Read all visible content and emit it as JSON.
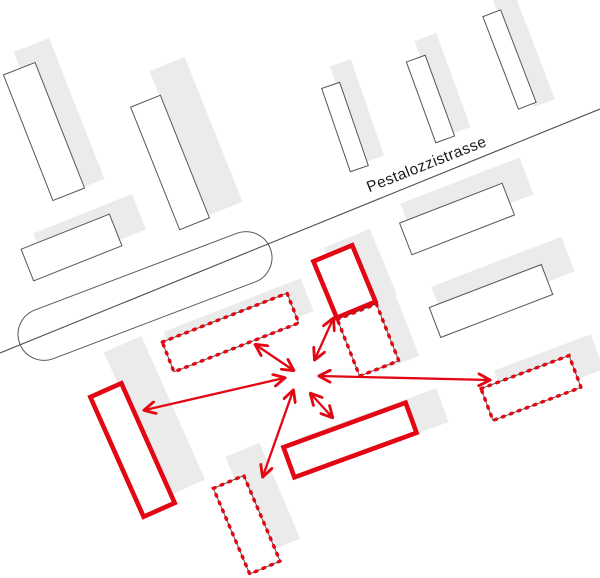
{
  "canvas": {
    "width": 600,
    "height": 578,
    "background": "#ffffff"
  },
  "palette": {
    "highlight_red": "#e30613",
    "shadow_gray": "#ebebeb",
    "building_outline": "#55565a",
    "dotted_underlay": "#4a4a4a",
    "street_line": "#4d4d4d",
    "label_color": "#1b1b1b",
    "building_fill": "#ffffff"
  },
  "street": {
    "label": "Pestalozzistrasse",
    "line": {
      "x1": 0,
      "y1": 353,
      "x2": 600,
      "y2": 109
    }
  },
  "plan": {
    "existing_buildings": [
      {
        "name": "existing-building-nw-1",
        "cx": 44,
        "cy": 131.5,
        "w": 34,
        "h": 135,
        "rot": -21.5,
        "shadow": {
          "dx": 15,
          "dy": -16,
          "s": 1.12
        }
      },
      {
        "name": "existing-building-nw-2",
        "cx": 170,
        "cy": 162.5,
        "w": 32,
        "h": 132,
        "rot": -21.8,
        "shadow": {
          "dx": 26,
          "dy": -26,
          "s": 1.18
        }
      },
      {
        "name": "existing-building-n-3",
        "cx": 345,
        "cy": 127,
        "w": 19,
        "h": 88,
        "rot": -19,
        "shadow": {
          "dx": 12,
          "dy": -16,
          "s": 1.16
        }
      },
      {
        "name": "existing-building-n-4",
        "cx": 430.5,
        "cy": 99,
        "w": 20,
        "h": 86,
        "rot": -20,
        "shadow": {
          "dx": 12,
          "dy": -15,
          "s": 1.16
        }
      },
      {
        "name": "existing-building-n-5",
        "cx": 509.5,
        "cy": 59.5,
        "w": 19,
        "h": 99,
        "rot": -21,
        "shadow": {
          "dx": 14,
          "dy": -11,
          "s": 1.18
        }
      },
      {
        "name": "existing-building-w-6",
        "cx": 71.5,
        "cy": 247.5,
        "w": 95,
        "h": 34,
        "rot": -21.7,
        "shadow": {
          "dx": 18,
          "dy": -16,
          "s": 1.12
        }
      },
      {
        "name": "existing-building-rounded-hall",
        "cx": 145,
        "cy": 296,
        "w": 268,
        "h": 52,
        "rot": -20.8,
        "rx": 26,
        "fill": "none",
        "shadow": null
      },
      {
        "name": "existing-building-e-7",
        "cx": 457,
        "cy": 219,
        "w": 110,
        "h": 34,
        "rot": -21.2,
        "shadow": {
          "dx": 10,
          "dy": -20,
          "s": 1.16
        }
      },
      {
        "name": "existing-building-e-8",
        "cx": 491,
        "cy": 301,
        "w": 120,
        "h": 32,
        "rot": -21,
        "shadow": {
          "dx": 12,
          "dy": -22,
          "s": 1.16
        }
      }
    ],
    "highlight_solid_buildings": [
      {
        "name": "proposed-building-north",
        "cx": 344.5,
        "cy": 281.5,
        "w": 42,
        "h": 61,
        "rot": -22.5,
        "shadow": {
          "dx": 16,
          "dy": -10,
          "s": 1.18
        }
      },
      {
        "name": "proposed-building-west",
        "cx": 132.5,
        "cy": 450,
        "w": 34,
        "h": 131,
        "rot": -24,
        "shadow": {
          "dx": 22,
          "dy": -34,
          "s": 1.2
        }
      },
      {
        "name": "proposed-building-south",
        "cx": 350,
        "cy": 440,
        "w": 130,
        "h": 32,
        "rot": -20,
        "shadow": {
          "dx": 24,
          "dy": -10,
          "s": 1.12
        }
      }
    ],
    "highlight_dotted_buildings": [
      {
        "name": "option-building-center-north",
        "cx": 368,
        "cy": 340,
        "w": 42,
        "h": 61,
        "rot": -21.5,
        "shadow": {
          "dx": 16,
          "dy": -8,
          "s": 1.15
        }
      },
      {
        "name": "option-building-center-west",
        "cx": 230.5,
        "cy": 332.5,
        "w": 134,
        "h": 32,
        "rot": -21.4,
        "shadow": {
          "dx": 8,
          "dy": -11,
          "s": 1.1
        }
      },
      {
        "name": "option-building-south",
        "cx": 246.75,
        "cy": 524.75,
        "w": 33,
        "h": 93,
        "rot": -23,
        "shadow": {
          "dx": 16,
          "dy": -27,
          "s": 1.12
        }
      },
      {
        "name": "option-building-east",
        "cx": 531,
        "cy": 388,
        "w": 94,
        "h": 34,
        "rot": -20.6,
        "shadow": {
          "dx": 18,
          "dy": -18,
          "s": 1.1
        }
      }
    ],
    "arrows": [
      {
        "name": "relation-arrow-northwest",
        "x1": 293,
        "y1": 370,
        "x2": 256,
        "y2": 345
      },
      {
        "name": "relation-arrow-north",
        "x1": 315,
        "y1": 359,
        "x2": 333,
        "y2": 319
      },
      {
        "name": "relation-arrow-west",
        "x1": 284,
        "y1": 378,
        "x2": 145,
        "y2": 410
      },
      {
        "name": "relation-arrow-east",
        "x1": 320,
        "y1": 376,
        "x2": 489,
        "y2": 380
      },
      {
        "name": "relation-arrow-southwest",
        "x1": 293,
        "y1": 391,
        "x2": 263,
        "y2": 476
      },
      {
        "name": "relation-arrow-southeast",
        "x1": 311,
        "y1": 394,
        "x2": 332,
        "y2": 417
      }
    ]
  }
}
